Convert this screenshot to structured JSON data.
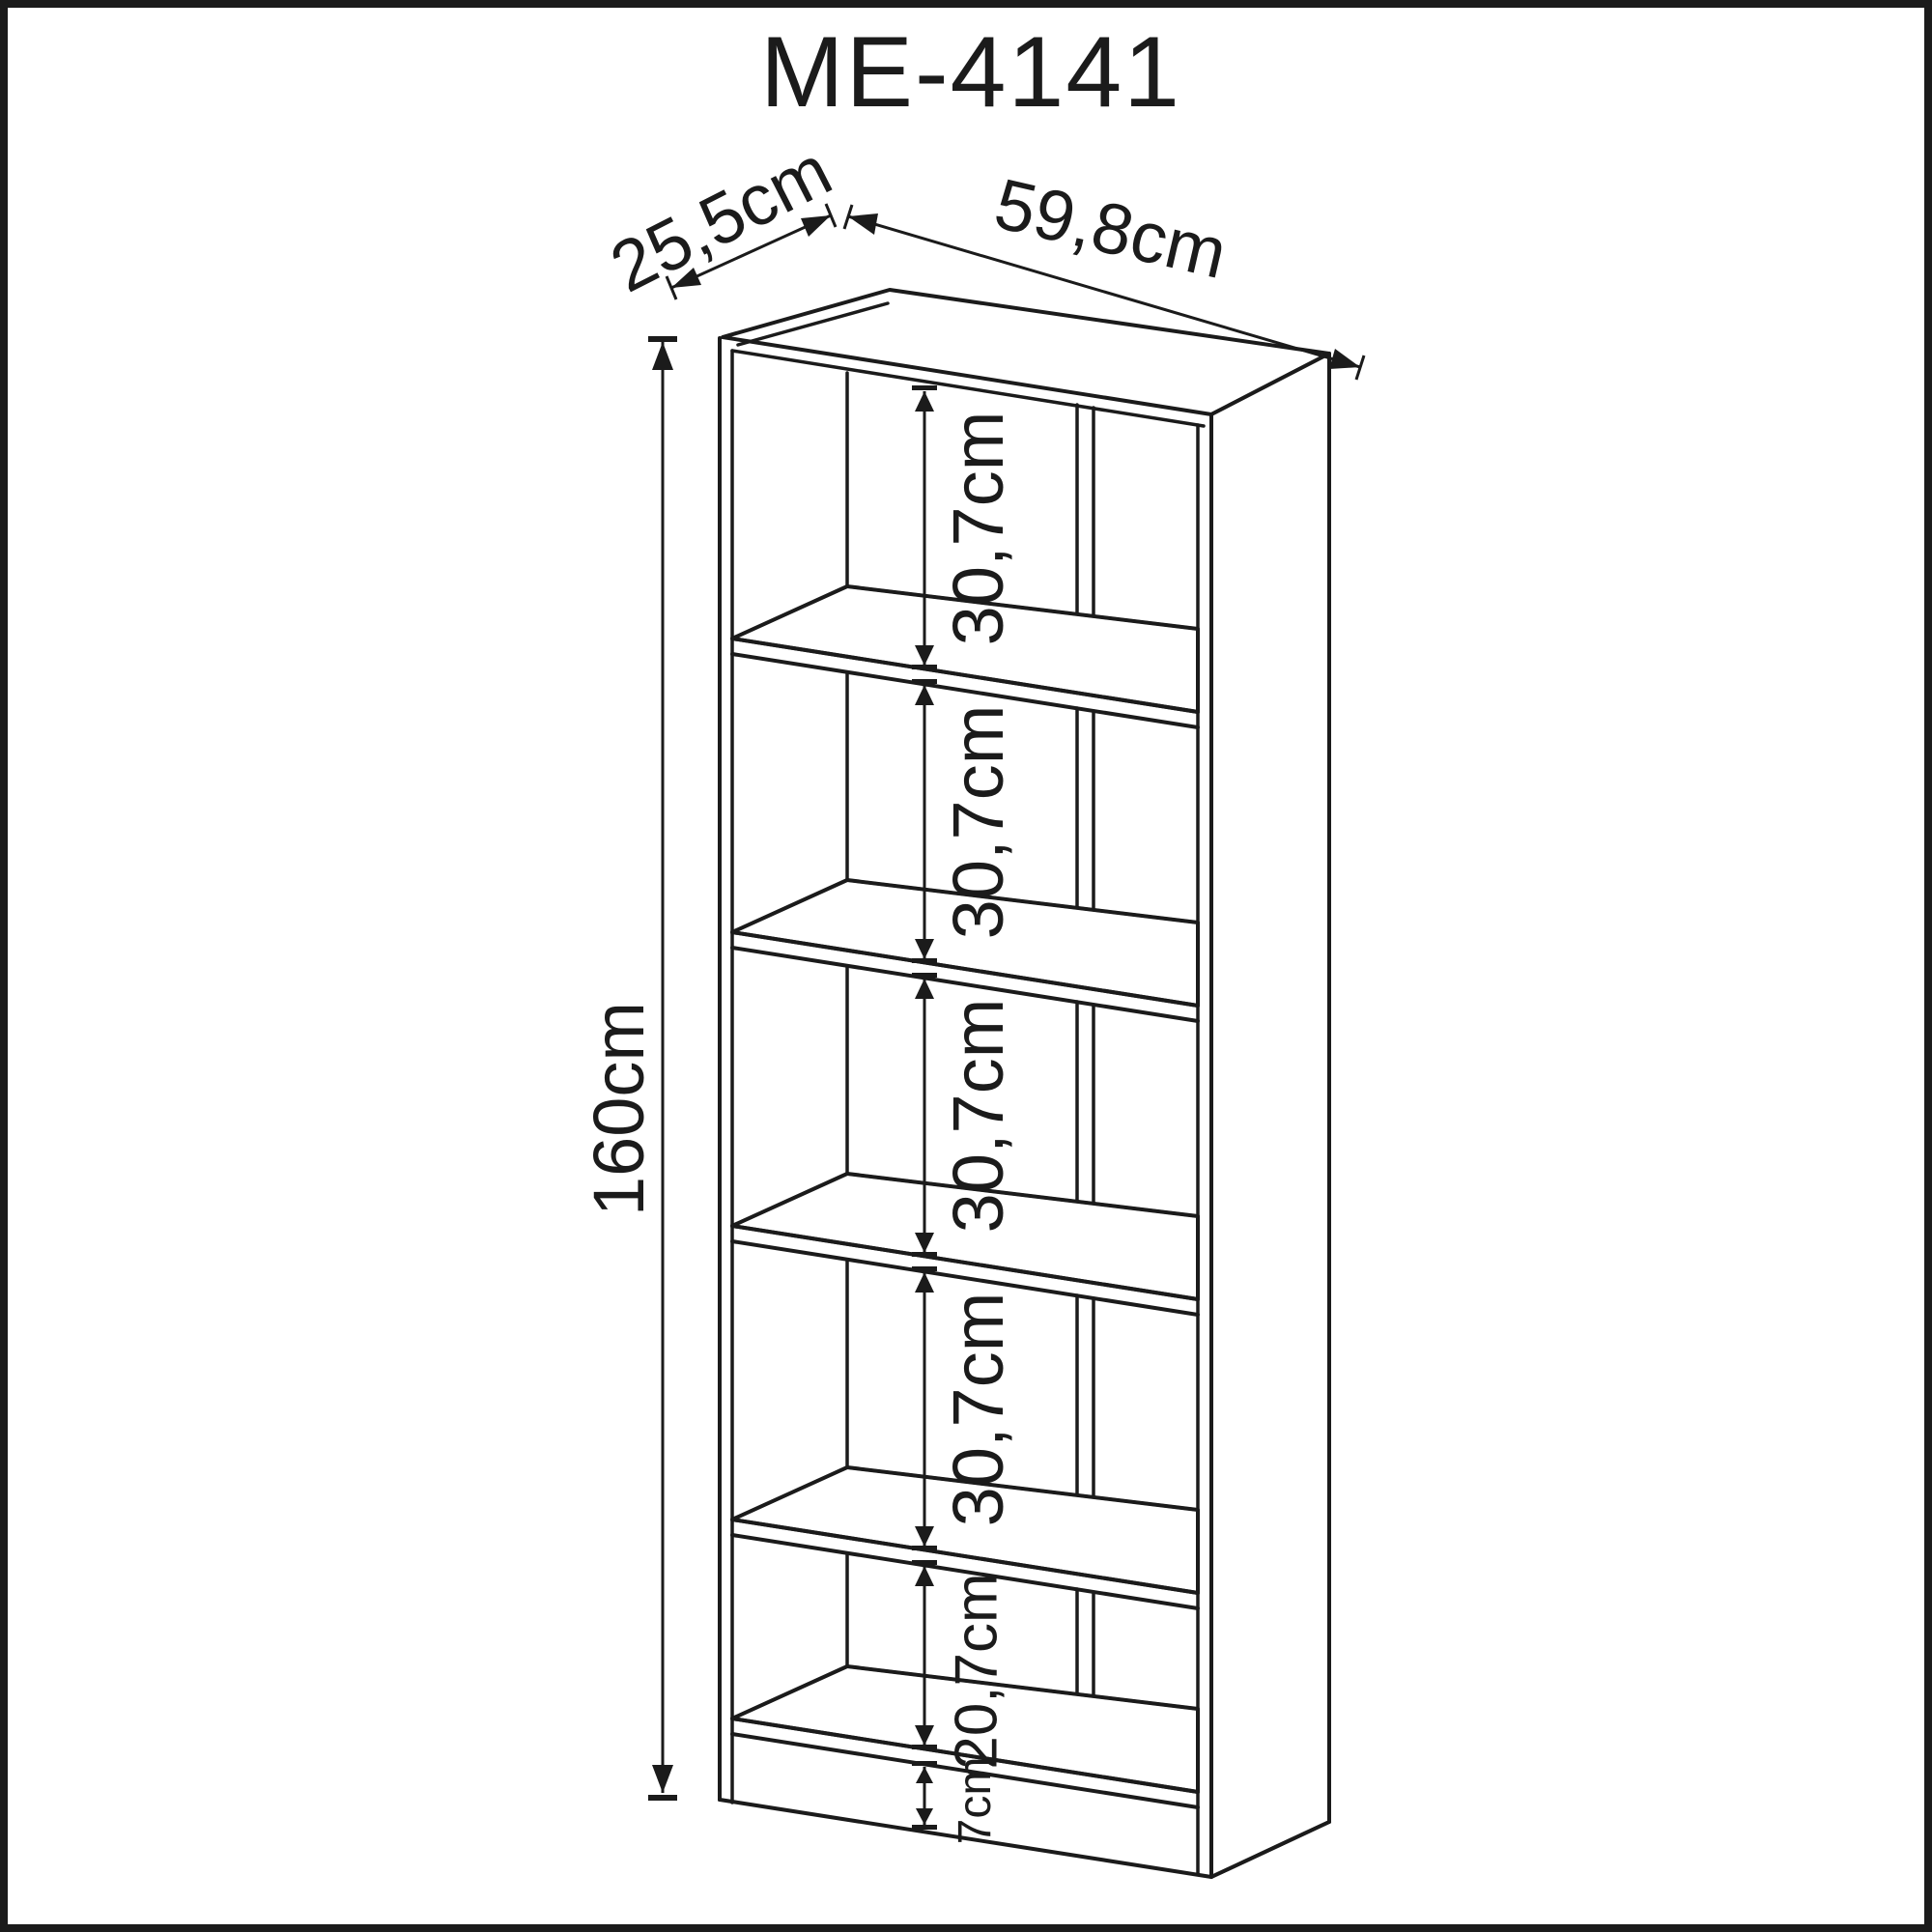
{
  "title": "ME-4141",
  "colors": {
    "ink": "#1b1b1b",
    "background": "#ffffff",
    "page_border": "#1b1b1b"
  },
  "dims": {
    "depth_label": "25,5cm",
    "width_label": "59,8cm",
    "height_label": "160cm",
    "bay_labels": [
      "30,7cm",
      "30,7cm",
      "30,7cm",
      "30,7cm",
      "20,7cm"
    ],
    "base_label": "7cm"
  }
}
